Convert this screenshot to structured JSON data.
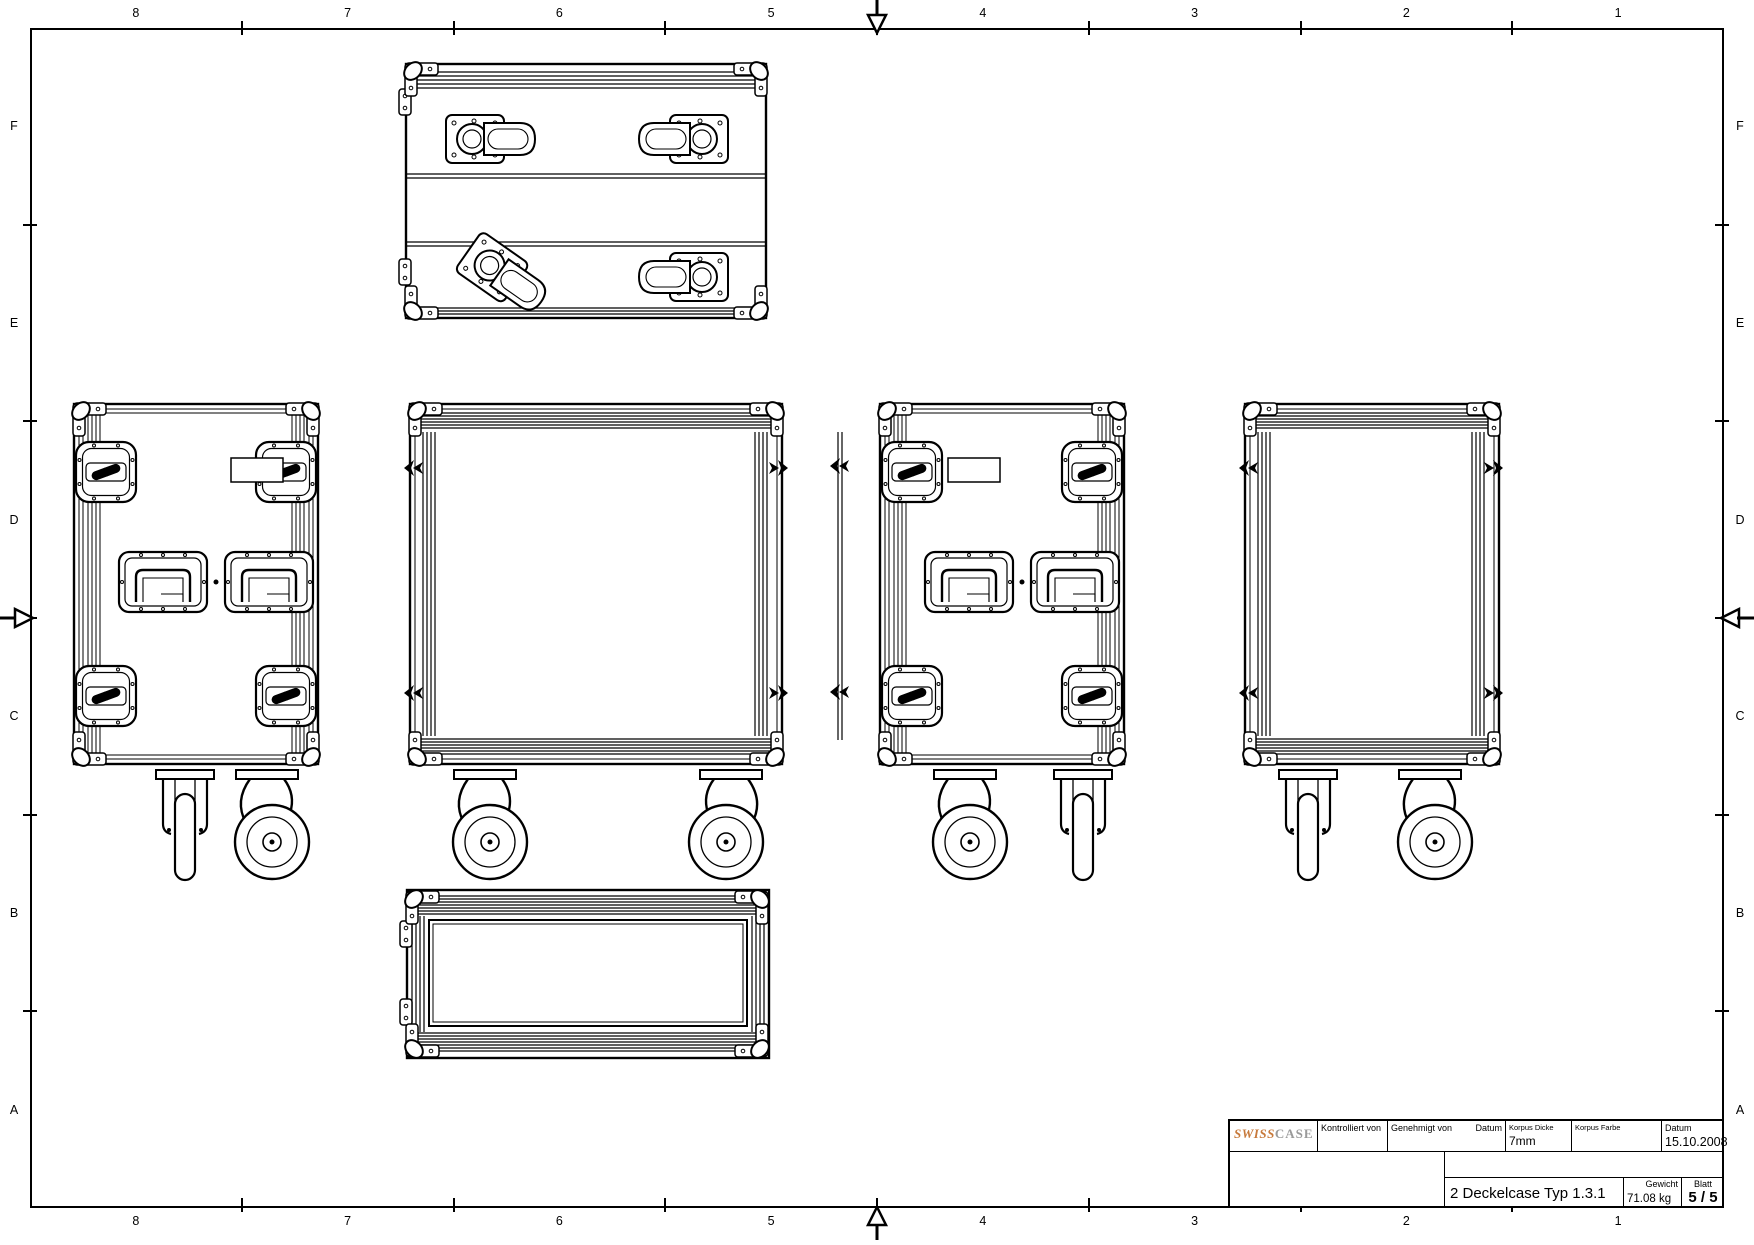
{
  "frame": {
    "columns": [
      "8",
      "7",
      "6",
      "5",
      "4",
      "3",
      "2",
      "1"
    ],
    "rows": [
      "F",
      "E",
      "D",
      "C",
      "B",
      "A"
    ]
  },
  "title_block": {
    "logo": {
      "swiss": "SWISS",
      "case": "CASE",
      "swiss_color": "#c7793b",
      "case_color": "#9a9a9a"
    },
    "kontrolliert_label": "Kontrolliert von",
    "genehmigt_label": "Genehmigt von",
    "datum_label": "Datum",
    "korpus_dicke_label": "Korpus Dicke",
    "korpus_dicke_value": "7mm",
    "korpus_farbe_label": "Korpus Farbe",
    "datum2_label": "Datum",
    "datum2_value": "15.10.2008",
    "title": "2 Deckelcase Typ 1.3.1",
    "gewicht_label": "Gewicht",
    "gewicht_value": "71.08 kg",
    "blatt_label": "Blatt",
    "blatt_value": "5 / 5"
  },
  "line_color": "#000000"
}
